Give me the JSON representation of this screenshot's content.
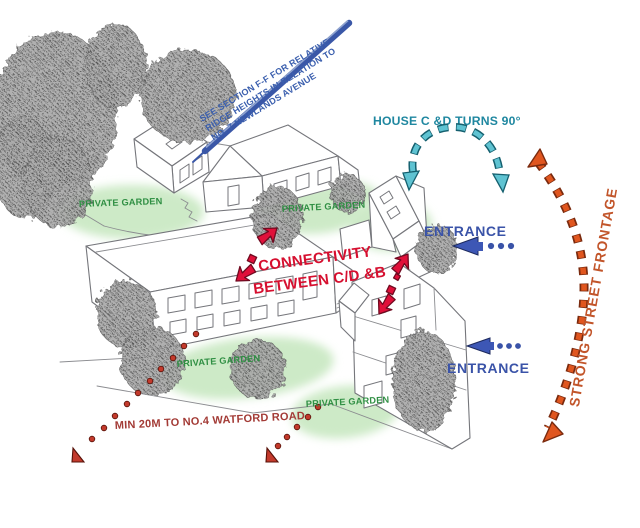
{
  "diagram": {
    "title_hint": "site massing sketch with design annotations",
    "section_note": {
      "line1": "SEE SECTION F-F FOR RELATIVE",
      "line2": "RIDGE HEIGHTS IN RELATION TO",
      "line3": "NO. 7 NEWLANDS AVENUE",
      "color": "#3b5fae"
    },
    "house_turns": {
      "label": "HOUSE C &D TURNS 90°",
      "color": "#1f87a0"
    },
    "entrance_upper": {
      "label": "ENTRANCE"
    },
    "entrance_lower": {
      "label": "ENTRANCE"
    },
    "entrance_color": "#3a53a8",
    "connectivity": {
      "line1": "CONNECTIVITY",
      "line2": "BETWEEN C/D &B",
      "color": "#d60f2f"
    },
    "street_frontage": {
      "label": "STRONG STREET FRONTAGE",
      "color": "#c2552a"
    },
    "watford": {
      "label": "MIN 20M TO NO.4 WATFORD ROAD",
      "color": "#a33b36"
    },
    "gardens": {
      "g1": "PRIVATE GARDEN",
      "g2": "PRIVATE GARDEN",
      "g3": "PRIVATE GARDEN",
      "g4": "PRIVATE GARDEN",
      "color": "#2f8f43"
    },
    "colors": {
      "section_line_blue": "#3a57a7",
      "teal_fill": "#5fc3d2",
      "teal_outline": "#15606f",
      "red_arrow": "#e0103a",
      "red_arrow_outline": "#6f0a20",
      "orange_dash": "#e0561f",
      "orange_outline": "#7a2a0e",
      "brick_dot": "#c33a2c",
      "brick_outline": "#571108",
      "garden_fill": "#cdeac7",
      "sketch_gray": "#75767b"
    }
  }
}
